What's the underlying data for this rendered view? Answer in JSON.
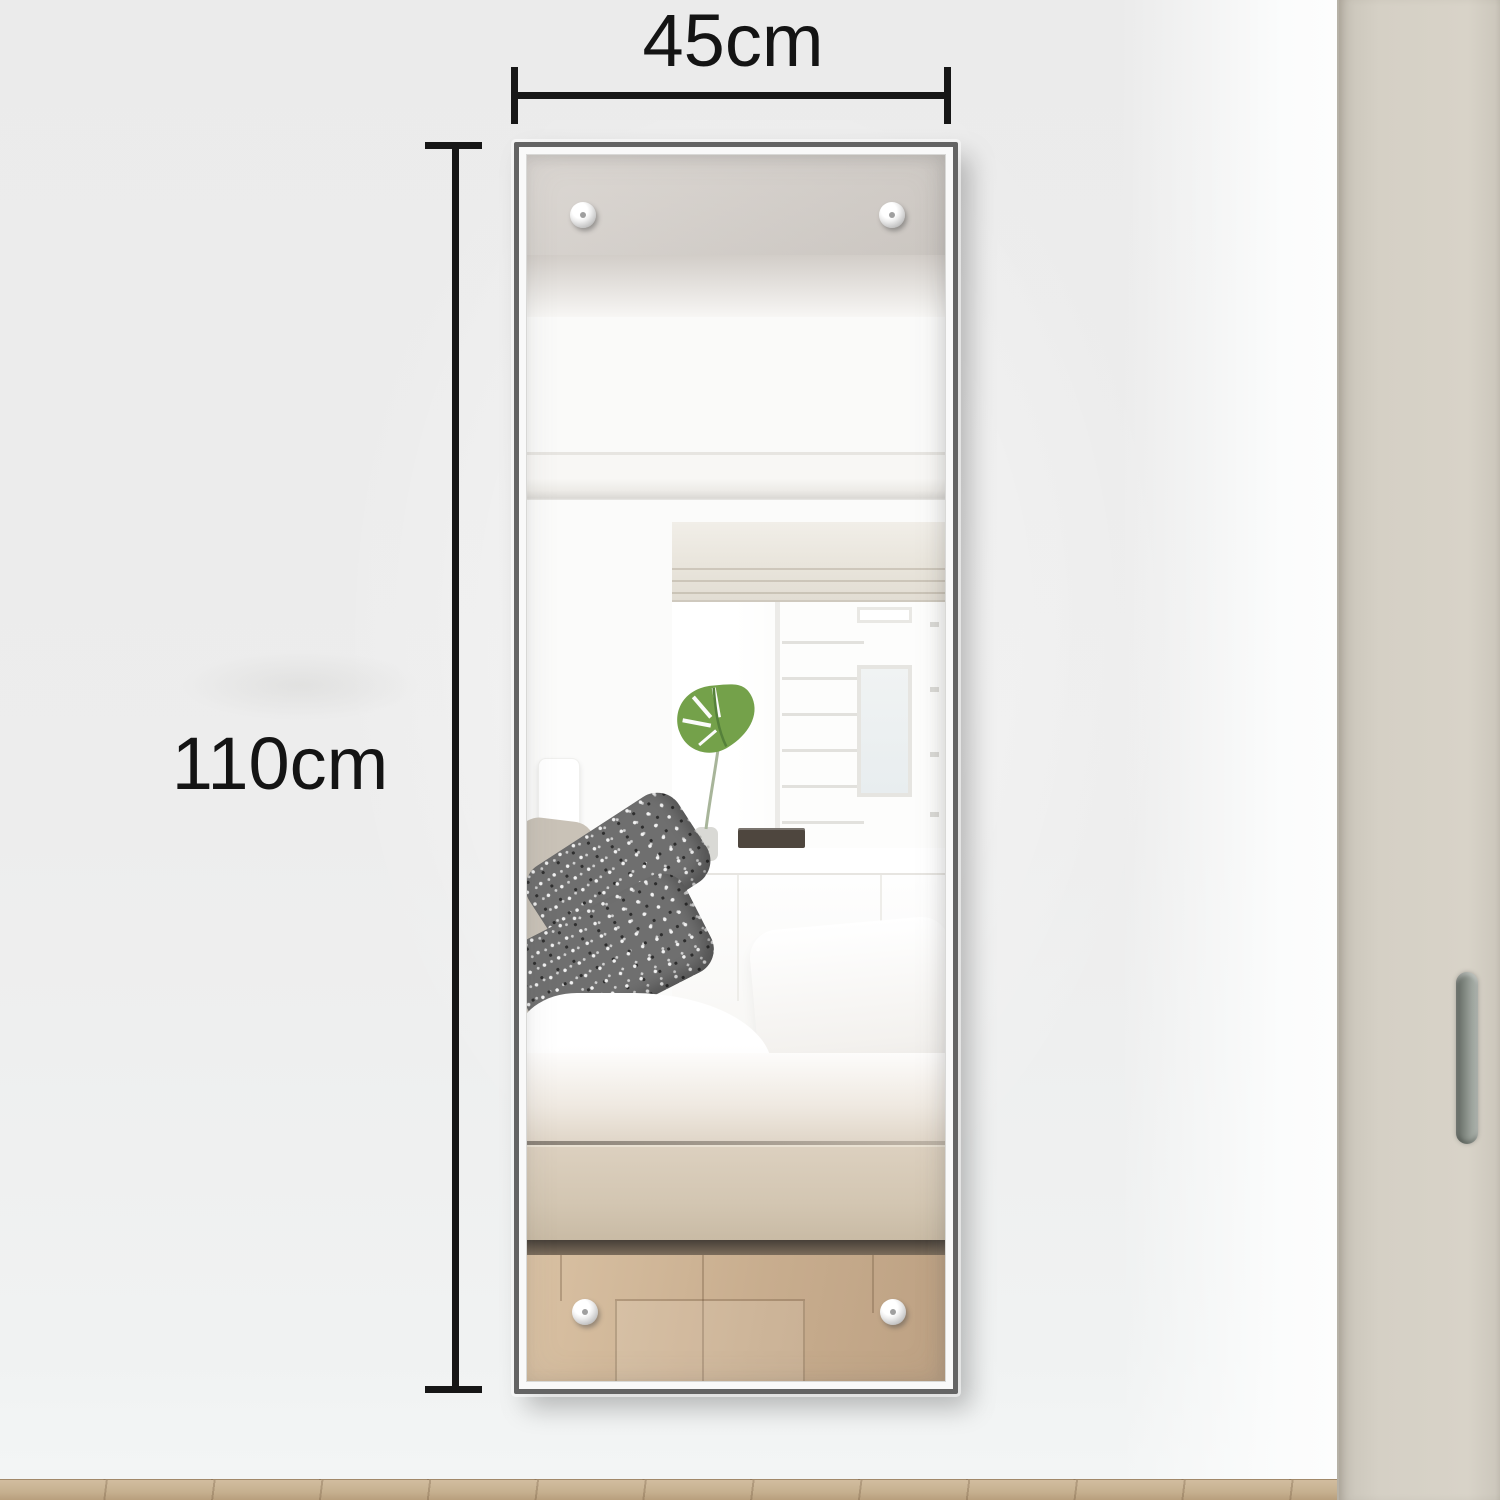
{
  "annotations": {
    "width": {
      "label": "45cm"
    },
    "height": {
      "label": "110cm"
    },
    "color": "#141414"
  },
  "mirror": {
    "frame_color": "#646464",
    "screw_count": 4
  },
  "reflection": {
    "elements": [
      "ceiling",
      "crown-molding",
      "window-shade",
      "window-shutters",
      "wall-lamp",
      "monstera-leaf",
      "vase",
      "shelf-books",
      "headboard",
      "beige-pillow",
      "speckled-pillows",
      "white-pillow",
      "duvet",
      "bed-base",
      "wood-floor"
    ],
    "leaf_color": "#74a14a",
    "bed_base_color": "#d3c6b2",
    "floor_color": "#c8ad8e"
  },
  "room": {
    "wall_color": "#ececec",
    "door_color": "#d5d0c5",
    "door_handle_color": "#7d847d",
    "floor_color": "#c6b08f"
  }
}
